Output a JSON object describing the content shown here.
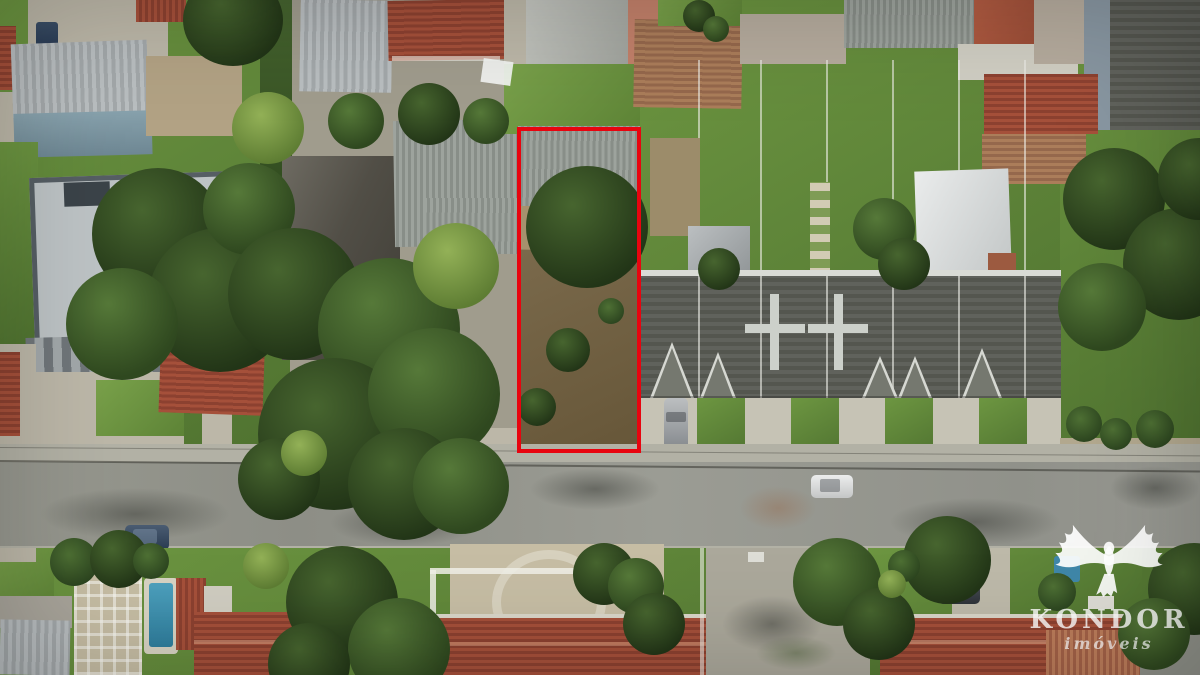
{
  "scene": {
    "description": "Top-down aerial drone photo of a residential block; a narrow vacant lot in the center is outlined in red"
  },
  "lot_highlight": {
    "label": "vacant-lot-boundary",
    "color": "#e8040f"
  },
  "watermark": {
    "brand": "KONDOR",
    "tagline": "imóveis",
    "icon": "condor-eagle-icon",
    "color": "#ffffff"
  }
}
